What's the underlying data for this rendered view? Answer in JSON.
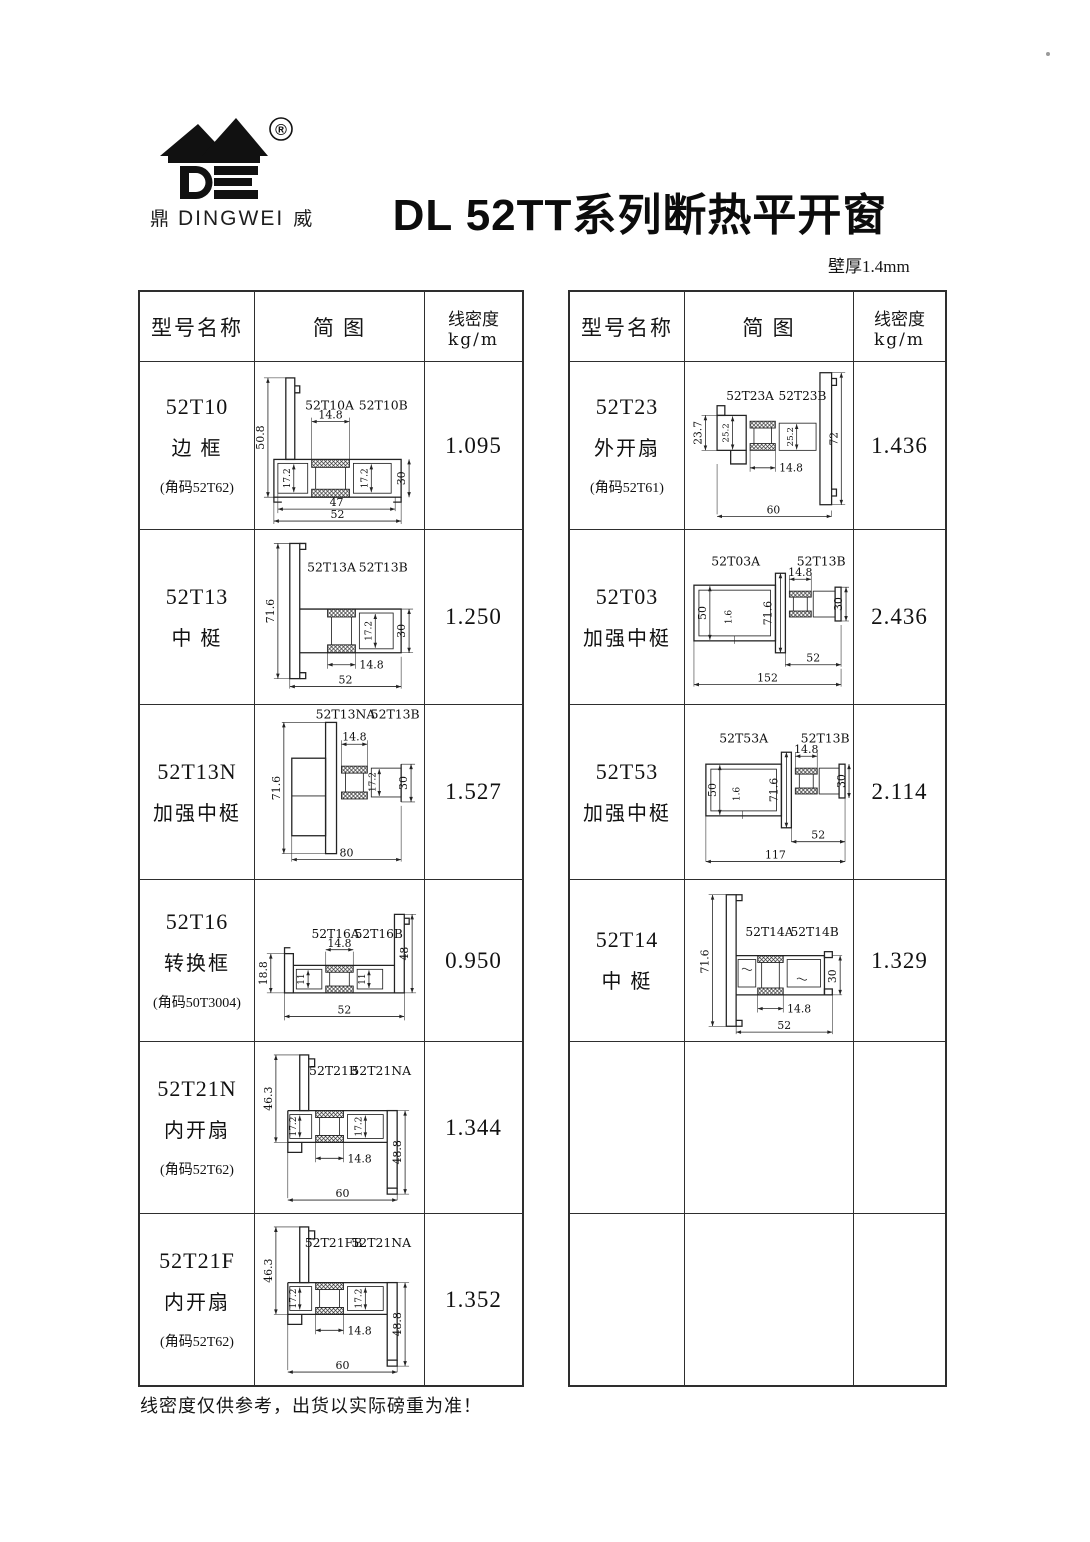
{
  "page": {
    "title": "DL 52TT系列断热平开窗",
    "wall_note": "壁厚1.4mm",
    "footer_note": "线密度仅供参考，出货以实际磅重为准！",
    "logo": {
      "registered": "®",
      "brand_cn_left": "鼎",
      "brand_en": "DINGWEI",
      "brand_cn_right": "威"
    }
  },
  "table_headers": {
    "model": "型号名称",
    "diagram": "简 图",
    "density_line1": "线密度",
    "density_line2": "kg/m"
  },
  "left_rows": [
    {
      "model": "52T10",
      "name": "边 框",
      "corner": "(角码52T62)",
      "density": "1.095",
      "labels": {
        "a": "52T10A",
        "b": "52T10B"
      },
      "dims": {
        "h_left": "50.8",
        "gap": "14.8",
        "cav_l": "17.2",
        "cav_r": "17.2",
        "h_right": "30",
        "w_inner": "47",
        "w_total": "52"
      }
    },
    {
      "model": "52T13",
      "name": "中 梃",
      "corner": "",
      "density": "1.250",
      "labels": {
        "a": "52T13A",
        "b": "52T13B"
      },
      "dims": {
        "h_left": "71.6",
        "cav_r": "17.2",
        "h_right": "30",
        "gap": "14.8",
        "w_total": "52"
      }
    },
    {
      "model": "52T13N",
      "name": "加强中梃",
      "corner": "",
      "density": "1.527",
      "labels": {
        "a": "52T13NA",
        "b": "52T13B"
      },
      "dims": {
        "h_left": "71.6",
        "gap": "14.8",
        "cav_r": "17.2",
        "h_right": "30",
        "w_total": "80"
      }
    },
    {
      "model": "52T16",
      "name": "转换框",
      "corner": "(角码50T3004)",
      "density": "0.950",
      "labels": {
        "a": "52T16A",
        "b": "52T16B"
      },
      "dims": {
        "h_left": "18.8",
        "cav_l": "11",
        "gap": "14.8",
        "cav_r": "11",
        "h_right": "48",
        "w_total": "52"
      }
    },
    {
      "model": "52T21N",
      "name": "内开扇",
      "corner": "(角码52T62)",
      "density": "1.344",
      "labels": {
        "a": "52T21B",
        "b": "52T21NA"
      },
      "dims": {
        "h_left": "46.3",
        "cav_l": "17.2",
        "cav_r": "17.2",
        "h_right": "48.8",
        "gap": "14.8",
        "w_total": "60"
      }
    },
    {
      "model": "52T21F",
      "name": "内开扇",
      "corner": "(角码52T62)",
      "density": "1.352",
      "labels": {
        "a": "52T21FB",
        "b": "52T21NA"
      },
      "dims": {
        "h_left": "46.3",
        "cav_l": "17.2",
        "cav_r": "17.2",
        "h_right": "48.8",
        "gap": "14.8",
        "w_total": "60"
      }
    }
  ],
  "right_rows": [
    {
      "model": "52T23",
      "name": "外开扇",
      "corner": "(角码52T61)",
      "density": "1.436",
      "labels": {
        "a": "52T23A",
        "b": "52T23B"
      },
      "dims": {
        "h_left": "23.7",
        "cav_l": "25.2",
        "cav_r": "25.2",
        "h_right": "72",
        "gap": "14.8",
        "w_total": "60"
      }
    },
    {
      "model": "52T03",
      "name": "加强中梃",
      "corner": "",
      "density": "2.436",
      "labels": {
        "a": "52T03A",
        "b": "52T13B"
      },
      "dims": {
        "box_h": "50",
        "wall": "1.6",
        "h_left": "71.6",
        "gap": "14.8",
        "h_right": "30",
        "w_part": "52",
        "w_total": "152"
      }
    },
    {
      "model": "52T53",
      "name": "加强中梃",
      "corner": "",
      "density": "2.114",
      "labels": {
        "a": "52T53A",
        "b": "52T13B"
      },
      "dims": {
        "box_h": "50",
        "wall": "1.6",
        "h_left": "71.6",
        "gap": "14.8",
        "h_right": "30",
        "w_part": "52",
        "w_total": "117"
      }
    },
    {
      "model": "52T14",
      "name": "中 梃",
      "corner": "",
      "density": "1.329",
      "labels": {
        "a": "52T14A",
        "b": "52T14B"
      },
      "dims": {
        "h_left": "71.6",
        "h_right": "30",
        "gap": "14.8",
        "w_total": "52"
      }
    },
    {
      "model": "",
      "name": "",
      "corner": "",
      "density": ""
    },
    {
      "model": "",
      "name": "",
      "corner": "",
      "density": ""
    }
  ]
}
